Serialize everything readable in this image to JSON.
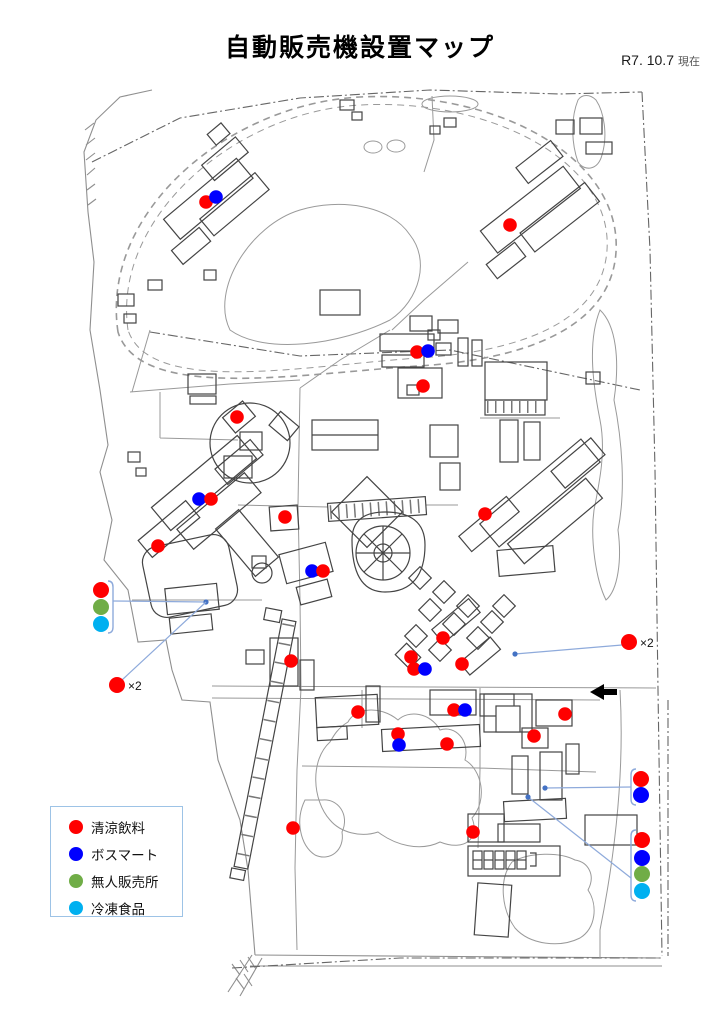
{
  "page": {
    "title": "自動販売機設置マップ",
    "date": "R7. 10.7",
    "date_suffix": "現在"
  },
  "legend": {
    "items": [
      {
        "key": "soft_drink",
        "label": "清涼飲料"
      },
      {
        "key": "bosmart",
        "label": "ボスマート"
      },
      {
        "key": "unmanned",
        "label": "無人販売所"
      },
      {
        "key": "frozen",
        "label": "冷凍食品"
      }
    ]
  },
  "colors": {
    "soft_drink": "#FF0000",
    "bosmart": "#0000FF",
    "unmanned": "#70AD47",
    "frozen": "#00B0F0",
    "callout_line": "#8EAADB",
    "anchor_dot": "#4472C4",
    "legend_border": "#9DC3E6"
  },
  "map_markers": [
    {
      "type": "soft_drink",
      "x": 206,
      "y": 202
    },
    {
      "type": "bosmart",
      "x": 216,
      "y": 197
    },
    {
      "type": "soft_drink",
      "x": 510,
      "y": 225
    },
    {
      "type": "soft_drink",
      "x": 417,
      "y": 352
    },
    {
      "type": "bosmart",
      "x": 428,
      "y": 351
    },
    {
      "type": "soft_drink",
      "x": 423,
      "y": 386
    },
    {
      "type": "soft_drink",
      "x": 237,
      "y": 417
    },
    {
      "type": "bosmart",
      "x": 199,
      "y": 499
    },
    {
      "type": "soft_drink",
      "x": 211,
      "y": 499
    },
    {
      "type": "soft_drink",
      "x": 285,
      "y": 517
    },
    {
      "type": "soft_drink",
      "x": 158,
      "y": 546
    },
    {
      "type": "soft_drink",
      "x": 485,
      "y": 514
    },
    {
      "type": "bosmart",
      "x": 312,
      "y": 571
    },
    {
      "type": "soft_drink",
      "x": 323,
      "y": 571
    },
    {
      "type": "soft_drink",
      "x": 443,
      "y": 638
    },
    {
      "type": "soft_drink",
      "x": 411,
      "y": 657
    },
    {
      "type": "soft_drink",
      "x": 414,
      "y": 669
    },
    {
      "type": "bosmart",
      "x": 425,
      "y": 669
    },
    {
      "type": "soft_drink",
      "x": 462,
      "y": 664
    },
    {
      "type": "soft_drink",
      "x": 291,
      "y": 661
    },
    {
      "type": "soft_drink",
      "x": 358,
      "y": 712
    },
    {
      "type": "soft_drink",
      "x": 398,
      "y": 734
    },
    {
      "type": "bosmart",
      "x": 399,
      "y": 745
    },
    {
      "type": "soft_drink",
      "x": 447,
      "y": 744
    },
    {
      "type": "soft_drink",
      "x": 454,
      "y": 710
    },
    {
      "type": "bosmart",
      "x": 465,
      "y": 710
    },
    {
      "type": "soft_drink",
      "x": 565,
      "y": 714
    },
    {
      "type": "soft_drink",
      "x": 534,
      "y": 736
    },
    {
      "type": "soft_drink",
      "x": 293,
      "y": 828
    },
    {
      "type": "soft_drink",
      "x": 473,
      "y": 832
    }
  ],
  "callouts": [
    {
      "name": "west-stack",
      "dots": [
        {
          "type": "soft_drink",
          "x": 101,
          "y": 590
        },
        {
          "type": "unmanned",
          "x": 101,
          "y": 607
        },
        {
          "type": "frozen",
          "x": 101,
          "y": 624
        }
      ],
      "bracket": {
        "x": 113,
        "y1": 581,
        "y2": 633,
        "dir": "left"
      },
      "line": [
        [
          113,
          601
        ],
        [
          206,
          602
        ]
      ],
      "anchor": {
        "x": 206,
        "y": 602
      }
    },
    {
      "name": "west-x2",
      "dots": [
        {
          "type": "soft_drink",
          "x": 117,
          "y": 685
        }
      ],
      "label": {
        "text": "×2",
        "x": 128,
        "y": 690
      },
      "line": [
        [
          122,
          680
        ],
        [
          206,
          602
        ]
      ]
    },
    {
      "name": "east-x2",
      "dots": [
        {
          "type": "soft_drink",
          "x": 629,
          "y": 642
        }
      ],
      "label": {
        "text": "×2",
        "x": 640,
        "y": 647
      },
      "line": [
        [
          622,
          645
        ],
        [
          515,
          654
        ]
      ],
      "anchor": {
        "x": 515,
        "y": 654
      }
    },
    {
      "name": "southeast-stack-upper",
      "dots": [
        {
          "type": "soft_drink",
          "x": 641,
          "y": 779
        },
        {
          "type": "bosmart",
          "x": 641,
          "y": 795
        }
      ],
      "bracket": {
        "x": 631,
        "y1": 769,
        "y2": 805,
        "dir": "right"
      },
      "line": [
        [
          631,
          787
        ],
        [
          545,
          788
        ]
      ],
      "anchor": {
        "x": 545,
        "y": 788
      }
    },
    {
      "name": "southeast-stack-lower",
      "dots": [
        {
          "type": "soft_drink",
          "x": 642,
          "y": 840
        },
        {
          "type": "bosmart",
          "x": 642,
          "y": 858
        },
        {
          "type": "unmanned",
          "x": 642,
          "y": 874
        },
        {
          "type": "frozen",
          "x": 642,
          "y": 891
        }
      ],
      "bracket": {
        "x": 631,
        "y1": 830,
        "y2": 901,
        "dir": "right"
      },
      "line": [
        [
          631,
          878
        ],
        [
          528,
          797
        ]
      ],
      "anchor": {
        "x": 528,
        "y": 797
      }
    }
  ],
  "entrance_arrow": {
    "x": 590,
    "y": 692,
    "dir": "left"
  }
}
